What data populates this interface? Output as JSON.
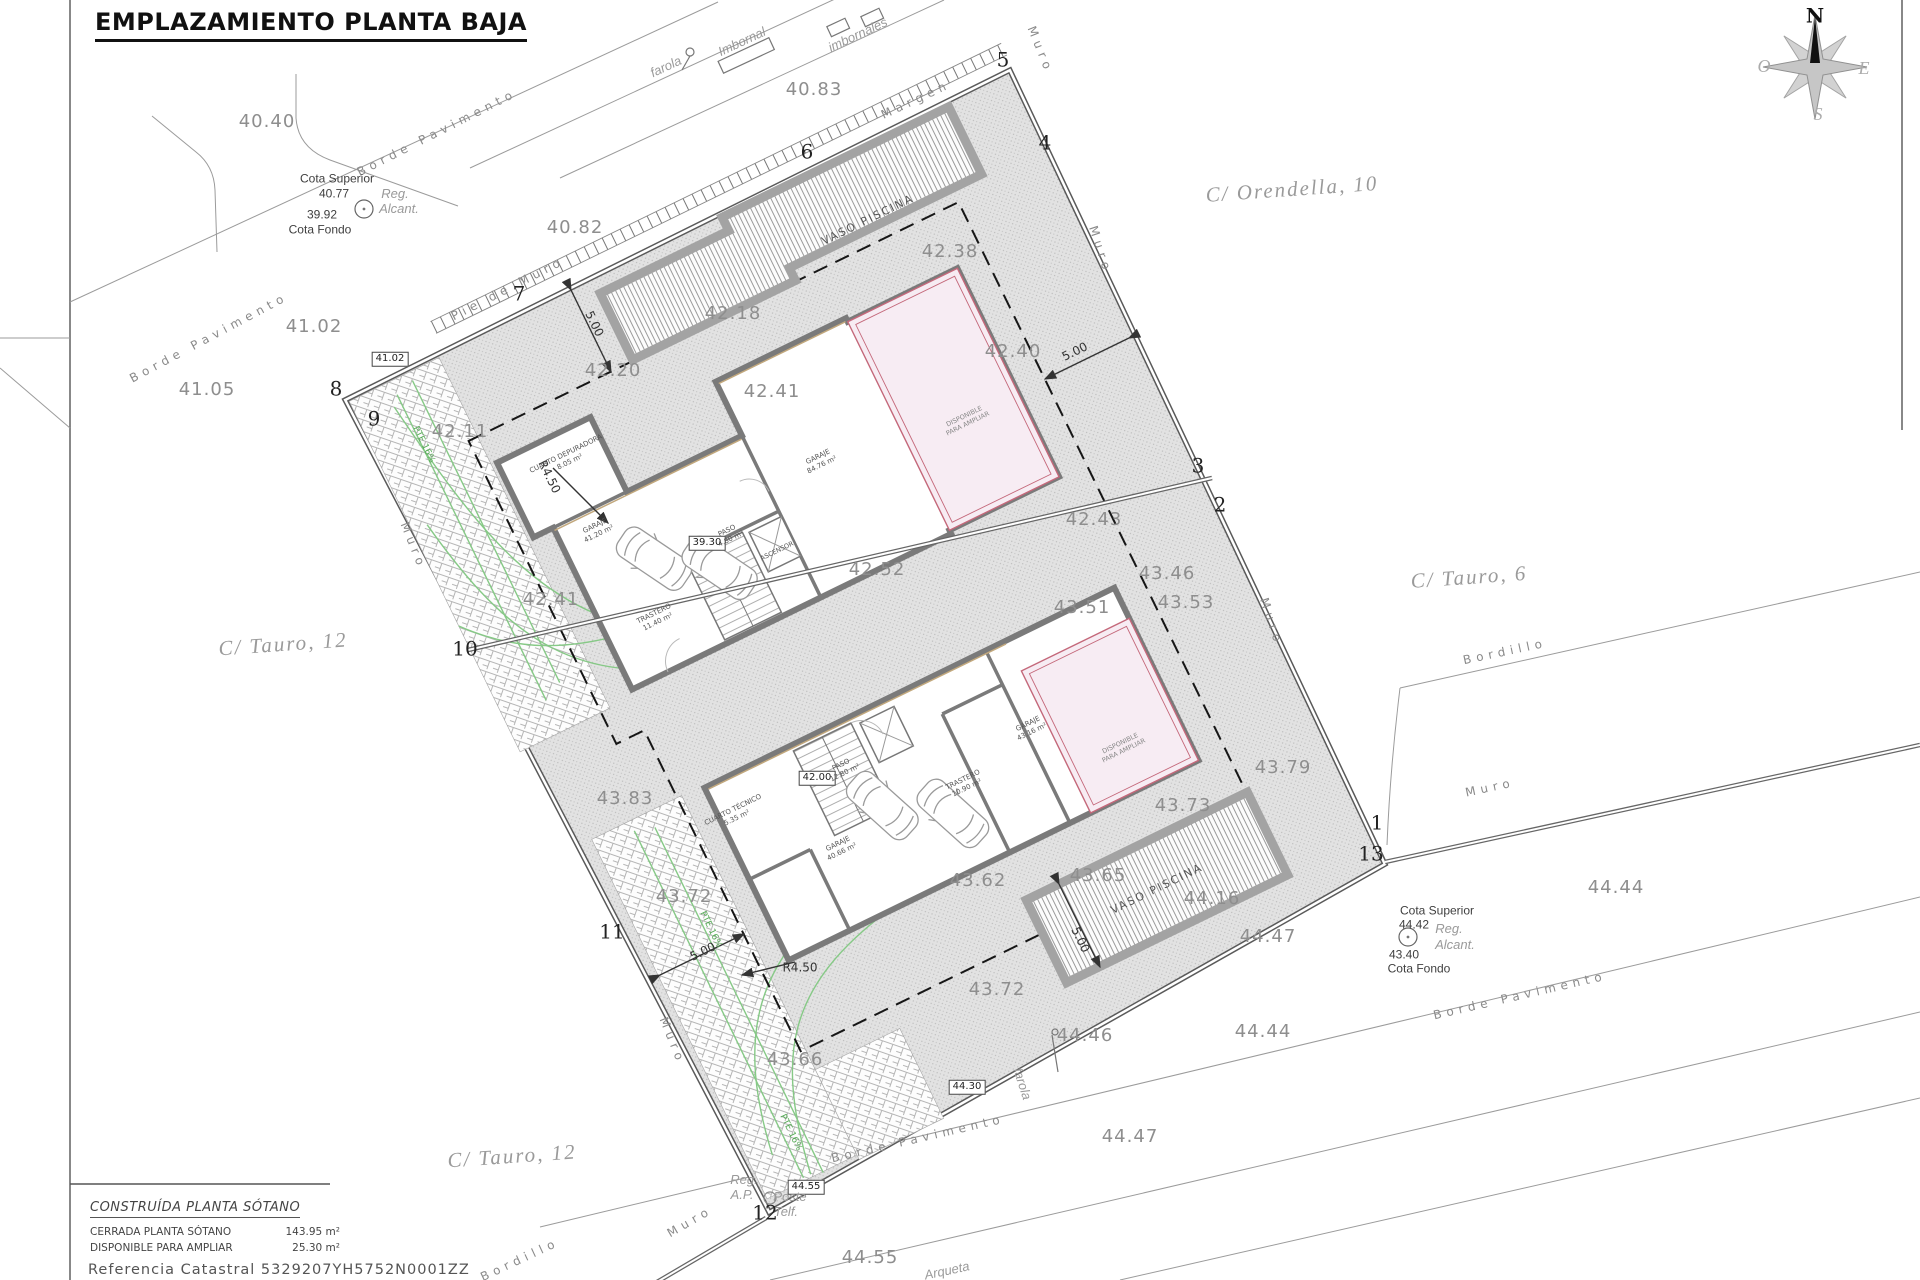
{
  "title": "EMPLAZAMIENTO PLANTA BAJA",
  "legend": {
    "heading": "CONSTRUÍDA PLANTA SÓTANO",
    "rows": [
      {
        "label": "CERRADA PLANTA SÓTANO",
        "value": "143.95 m²"
      },
      {
        "label": "DISPONIBLE PARA AMPLIAR",
        "value": "25.30 m²"
      }
    ],
    "reference": "Referencia  Catastral  5329207YH5752N0001ZZ"
  },
  "compass": {
    "north": "N",
    "south": "S",
    "east": "E",
    "west": "O"
  },
  "accent_colors": {
    "wall_gray": "#7a7a7a",
    "reform_pink": "#f7ecf3",
    "reform_border": "#c4687a",
    "green": "#86c986"
  },
  "labels": [
    {
      "t": "40.40",
      "x": 267,
      "y": 122,
      "k": "c"
    },
    {
      "t": "40.82",
      "x": 575,
      "y": 228,
      "k": "c"
    },
    {
      "t": "40.83",
      "x": 814,
      "y": 90,
      "k": "c"
    },
    {
      "t": "41.02",
      "x": 314,
      "y": 327,
      "k": "c"
    },
    {
      "t": "41.05",
      "x": 207,
      "y": 390,
      "k": "c"
    },
    {
      "t": "42.11",
      "x": 460,
      "y": 432,
      "k": "c"
    },
    {
      "t": "42.20",
      "x": 613,
      "y": 371,
      "k": "c"
    },
    {
      "t": "42.18",
      "x": 733,
      "y": 314,
      "k": "c"
    },
    {
      "t": "42.38",
      "x": 950,
      "y": 252,
      "k": "c"
    },
    {
      "t": "42.40",
      "x": 1013,
      "y": 352,
      "k": "c"
    },
    {
      "t": "42.41",
      "x": 551,
      "y": 600,
      "k": "c"
    },
    {
      "t": "42.41",
      "x": 772,
      "y": 392,
      "k": "c"
    },
    {
      "t": "42.43",
      "x": 1094,
      "y": 520,
      "k": "c"
    },
    {
      "t": "42.52",
      "x": 877,
      "y": 570,
      "k": "c"
    },
    {
      "t": "43.46",
      "x": 1167,
      "y": 574,
      "k": "c"
    },
    {
      "t": "43.53",
      "x": 1186,
      "y": 603,
      "k": "c"
    },
    {
      "t": "43.51",
      "x": 1082,
      "y": 608,
      "k": "c"
    },
    {
      "t": "43.79",
      "x": 1283,
      "y": 768,
      "k": "c"
    },
    {
      "t": "43.83",
      "x": 625,
      "y": 799,
      "k": "c"
    },
    {
      "t": "43.73",
      "x": 1183,
      "y": 806,
      "k": "c"
    },
    {
      "t": "43.65",
      "x": 1098,
      "y": 876,
      "k": "c"
    },
    {
      "t": "44.16",
      "x": 1212,
      "y": 899,
      "k": "c"
    },
    {
      "t": "43.62",
      "x": 978,
      "y": 881,
      "k": "c"
    },
    {
      "t": "43.72",
      "x": 684,
      "y": 897,
      "k": "c"
    },
    {
      "t": "43.72",
      "x": 997,
      "y": 990,
      "k": "c"
    },
    {
      "t": "43.66",
      "x": 795,
      "y": 1060,
      "k": "c"
    },
    {
      "t": "44.47",
      "x": 1268,
      "y": 937,
      "k": "c"
    },
    {
      "t": "44.44",
      "x": 1616,
      "y": 888,
      "k": "c"
    },
    {
      "t": "44.47",
      "x": 1130,
      "y": 1137,
      "k": "c"
    },
    {
      "t": "44.44",
      "x": 1263,
      "y": 1032,
      "k": "c"
    },
    {
      "t": "44.46",
      "x": 1085,
      "y": 1036,
      "k": "c"
    },
    {
      "t": "44.55",
      "x": 870,
      "y": 1258,
      "k": "c"
    },
    {
      "t": "1",
      "x": 1377,
      "y": 823,
      "k": "p"
    },
    {
      "t": "2",
      "x": 1220,
      "y": 505,
      "k": "p"
    },
    {
      "t": "3",
      "x": 1198,
      "y": 466,
      "k": "p"
    },
    {
      "t": "4",
      "x": 1045,
      "y": 143,
      "k": "p"
    },
    {
      "t": "5",
      "x": 1003,
      "y": 60,
      "k": "p"
    },
    {
      "t": "6",
      "x": 807,
      "y": 152,
      "k": "p"
    },
    {
      "t": "7",
      "x": 519,
      "y": 294,
      "k": "p"
    },
    {
      "t": "8",
      "x": 336,
      "y": 389,
      "k": "p"
    },
    {
      "t": "9",
      "x": 374,
      "y": 419,
      "k": "p"
    },
    {
      "t": "10",
      "x": 465,
      "y": 649,
      "k": "p"
    },
    {
      "t": "11",
      "x": 612,
      "y": 932,
      "k": "p"
    },
    {
      "t": "12",
      "x": 765,
      "y": 1213,
      "k": "p"
    },
    {
      "t": "13",
      "x": 1371,
      "y": 854,
      "k": "p"
    },
    {
      "t": "41.02",
      "x": 390,
      "y": 359,
      "k": "b"
    },
    {
      "t": "39.30",
      "x": 707,
      "y": 543,
      "k": "b"
    },
    {
      "t": "42.00",
      "x": 817,
      "y": 778,
      "k": "b"
    },
    {
      "t": "44.30",
      "x": 967,
      "y": 1087,
      "k": "b"
    },
    {
      "t": "44.55",
      "x": 806,
      "y": 1187,
      "k": "b"
    },
    {
      "t": "C/  Orendella,  10",
      "x": 1292,
      "y": 189,
      "k": "s",
      "r": -4
    },
    {
      "t": "C/  Tauro,  6",
      "x": 1469,
      "y": 577,
      "k": "s",
      "r": -4
    },
    {
      "t": "C/  Tauro,  12",
      "x": 283,
      "y": 644,
      "k": "s",
      "r": -4
    },
    {
      "t": "C/  Tauro,  12",
      "x": 512,
      "y": 1156,
      "k": "s",
      "r": -4
    },
    {
      "t": "Muro",
      "x": 1040,
      "y": 50,
      "k": "m",
      "r": 68
    },
    {
      "t": "Muro",
      "x": 1100,
      "y": 250,
      "k": "m",
      "r": 72
    },
    {
      "t": "Muro",
      "x": 413,
      "y": 546,
      "k": "m",
      "r": 68
    },
    {
      "t": "Muro",
      "x": 1271,
      "y": 622,
      "k": "m",
      "r": 72
    },
    {
      "t": "Muro",
      "x": 672,
      "y": 1041,
      "k": "m",
      "r": 68
    },
    {
      "t": "Muro",
      "x": 690,
      "y": 1222,
      "k": "m",
      "r": -30
    },
    {
      "t": "Muro",
      "x": 1490,
      "y": 788,
      "k": "m",
      "r": -12
    },
    {
      "t": "Pie  de  Muro",
      "x": 508,
      "y": 289,
      "k": "m",
      "r": -27
    },
    {
      "t": "Margen",
      "x": 916,
      "y": 100,
      "k": "m",
      "r": -25
    },
    {
      "t": "Bordillo",
      "x": 1505,
      "y": 652,
      "k": "m",
      "r": -12
    },
    {
      "t": "Bordillo",
      "x": 520,
      "y": 1260,
      "k": "m",
      "r": -25
    },
    {
      "t": "Borde  Pavimento",
      "x": 437,
      "y": 133,
      "k": "m",
      "r": -27
    },
    {
      "t": "Borde  Pavimento",
      "x": 209,
      "y": 338,
      "k": "m",
      "r": -28
    },
    {
      "t": "Borde  Pavimento",
      "x": 918,
      "y": 1139,
      "k": "m",
      "r": -13
    },
    {
      "t": "Borde  Pavimento",
      "x": 1520,
      "y": 996,
      "k": "m",
      "r": -13
    },
    {
      "t": "farola",
      "x": 666,
      "y": 67,
      "k": "a",
      "r": -25
    },
    {
      "t": "Imbornal",
      "x": 742,
      "y": 42,
      "k": "a",
      "r": -25
    },
    {
      "t": "imbornales",
      "x": 858,
      "y": 35,
      "k": "a",
      "r": -25
    },
    {
      "t": "farola",
      "x": 1022,
      "y": 1084,
      "k": "a",
      "r": 72
    },
    {
      "t": "Reg.",
      "x": 395,
      "y": 194,
      "k": "a"
    },
    {
      "t": "Alcant.",
      "x": 399,
      "y": 209,
      "k": "a"
    },
    {
      "t": "Reg.",
      "x": 1449,
      "y": 929,
      "k": "a"
    },
    {
      "t": "Alcant.",
      "x": 1455,
      "y": 945,
      "k": "a"
    },
    {
      "t": "Reg.",
      "x": 744,
      "y": 1180,
      "k": "a"
    },
    {
      "t": "A.P.",
      "x": 742,
      "y": 1195,
      "k": "a"
    },
    {
      "t": "Poste",
      "x": 790,
      "y": 1197,
      "k": "a"
    },
    {
      "t": "Telf.",
      "x": 786,
      "y": 1212,
      "k": "a"
    },
    {
      "t": "Arqueta",
      "x": 947,
      "y": 1271,
      "k": "a",
      "r": -12
    },
    {
      "t": "Cota  Superior",
      "x": 337,
      "y": 179,
      "k": "d"
    },
    {
      "t": "40.77",
      "x": 334,
      "y": 194,
      "k": "d"
    },
    {
      "t": "39.92",
      "x": 322,
      "y": 215,
      "k": "d"
    },
    {
      "t": "Cota  Fondo",
      "x": 320,
      "y": 230,
      "k": "d"
    },
    {
      "t": "Cota  Superior",
      "x": 1437,
      "y": 911,
      "k": "d"
    },
    {
      "t": "44.42",
      "x": 1414,
      "y": 925,
      "k": "d"
    },
    {
      "t": "43.40",
      "x": 1404,
      "y": 955,
      "k": "d"
    },
    {
      "t": "Cota  Fondo",
      "x": 1419,
      "y": 969,
      "k": "d"
    },
    {
      "t": "5.00",
      "x": 594,
      "y": 324,
      "k": "dm",
      "r": 64
    },
    {
      "t": "5.00",
      "x": 1075,
      "y": 352,
      "k": "dm",
      "r": -26
    },
    {
      "t": "5.00",
      "x": 703,
      "y": 952,
      "k": "dm",
      "r": -26
    },
    {
      "t": "5.00",
      "x": 1080,
      "y": 940,
      "k": "dm",
      "r": 64
    },
    {
      "t": "R4.50",
      "x": 549,
      "y": 477,
      "k": "dm",
      "r": 64
    },
    {
      "t": "R4.50",
      "x": 800,
      "y": 968,
      "k": "dm"
    },
    {
      "t": "PTE 16%",
      "x": 423,
      "y": 445,
      "k": "g",
      "r": 64
    },
    {
      "t": "PTE 16%",
      "x": 710,
      "y": 930,
      "k": "g",
      "r": 64
    },
    {
      "t": "PTE 16%",
      "x": 790,
      "y": 1133,
      "k": "g",
      "r": 64
    },
    {
      "t": "CUARTO DEPURADORA|8.05 m²",
      "x": 568,
      "y": 458,
      "k": "rm",
      "r": -26
    },
    {
      "t": "GARAJE|41.20 m²",
      "x": 597,
      "y": 530,
      "k": "rm",
      "r": -26
    },
    {
      "t": "GARAJE|84.76 m²",
      "x": 820,
      "y": 461,
      "k": "rm",
      "r": -26
    },
    {
      "t": "PASO|4.80 m²",
      "x": 729,
      "y": 535,
      "k": "rm",
      "r": -26
    },
    {
      "t": "ASCENSOR",
      "x": 777,
      "y": 551,
      "k": "rm1",
      "r": -26
    },
    {
      "t": "TRASTERO|11.40 m²",
      "x": 656,
      "y": 618,
      "k": "rm",
      "r": -26
    },
    {
      "t": "CUARTO TÉCNICO|5.35 m²",
      "x": 735,
      "y": 814,
      "k": "rm",
      "r": -26
    },
    {
      "t": "PASO|12.80 m²",
      "x": 843,
      "y": 769,
      "k": "rm",
      "r": -26
    },
    {
      "t": "GARAJE|40.66 m²",
      "x": 840,
      "y": 848,
      "k": "rm",
      "r": -26
    },
    {
      "t": "TRASTERO|10.90 m²",
      "x": 965,
      "y": 784,
      "k": "rm",
      "r": -26
    },
    {
      "t": "GARAJE|43.16 m²",
      "x": 1030,
      "y": 728,
      "k": "rm",
      "r": -26
    },
    {
      "t": "VASO PISCINA",
      "x": 868,
      "y": 220,
      "k": "pl",
      "r": -26
    },
    {
      "t": "VASO PISCINA",
      "x": 1157,
      "y": 889,
      "k": "pl",
      "r": -26
    },
    {
      "t": "DISPONIBLE|PARA AMPLIAR",
      "x": 966,
      "y": 420,
      "k": "pk",
      "r": -26
    },
    {
      "t": "DISPONIBLE|PARA AMPLIAR",
      "x": 1122,
      "y": 747,
      "k": "pk",
      "r": -26
    }
  ]
}
